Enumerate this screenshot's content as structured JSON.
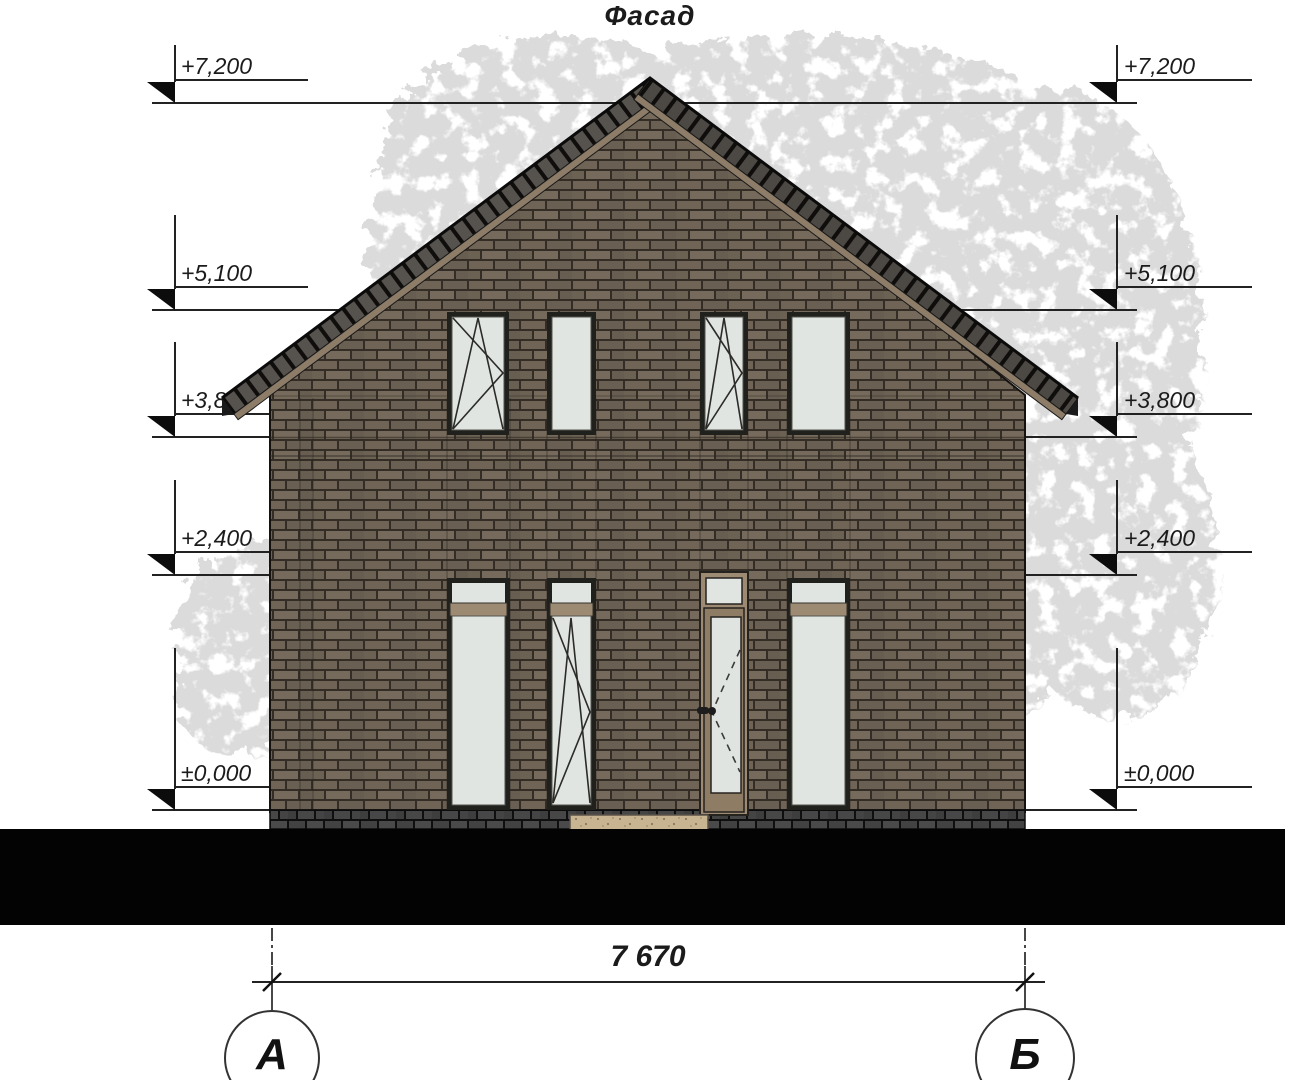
{
  "drawing": {
    "title": "Фасад"
  },
  "elevation_marks": {
    "left": [
      "+7,200",
      "+5,100",
      "+3,800",
      "+2,400",
      "±0,000"
    ],
    "right": [
      "+7,200",
      "+5,100",
      "+3,800",
      "+2,400",
      "±0,000"
    ]
  },
  "dimension": {
    "overall_width": "7 670"
  },
  "axes": {
    "left": "А",
    "right": "Б"
  },
  "colors": {
    "brick": "#6f6456",
    "mortar": "#332d26",
    "plinth_brick": "#454545",
    "roof_tile": "#56524d",
    "roof_fascia": "#8d7c67",
    "window_glass": "#e0e5e2",
    "window_frame": "#20201d",
    "door_frame": "#9c8a72",
    "door_step": "#c9b492",
    "ground": "#030303",
    "tree_foliage": "#b3b3b3",
    "line": "#1b1b1b"
  }
}
